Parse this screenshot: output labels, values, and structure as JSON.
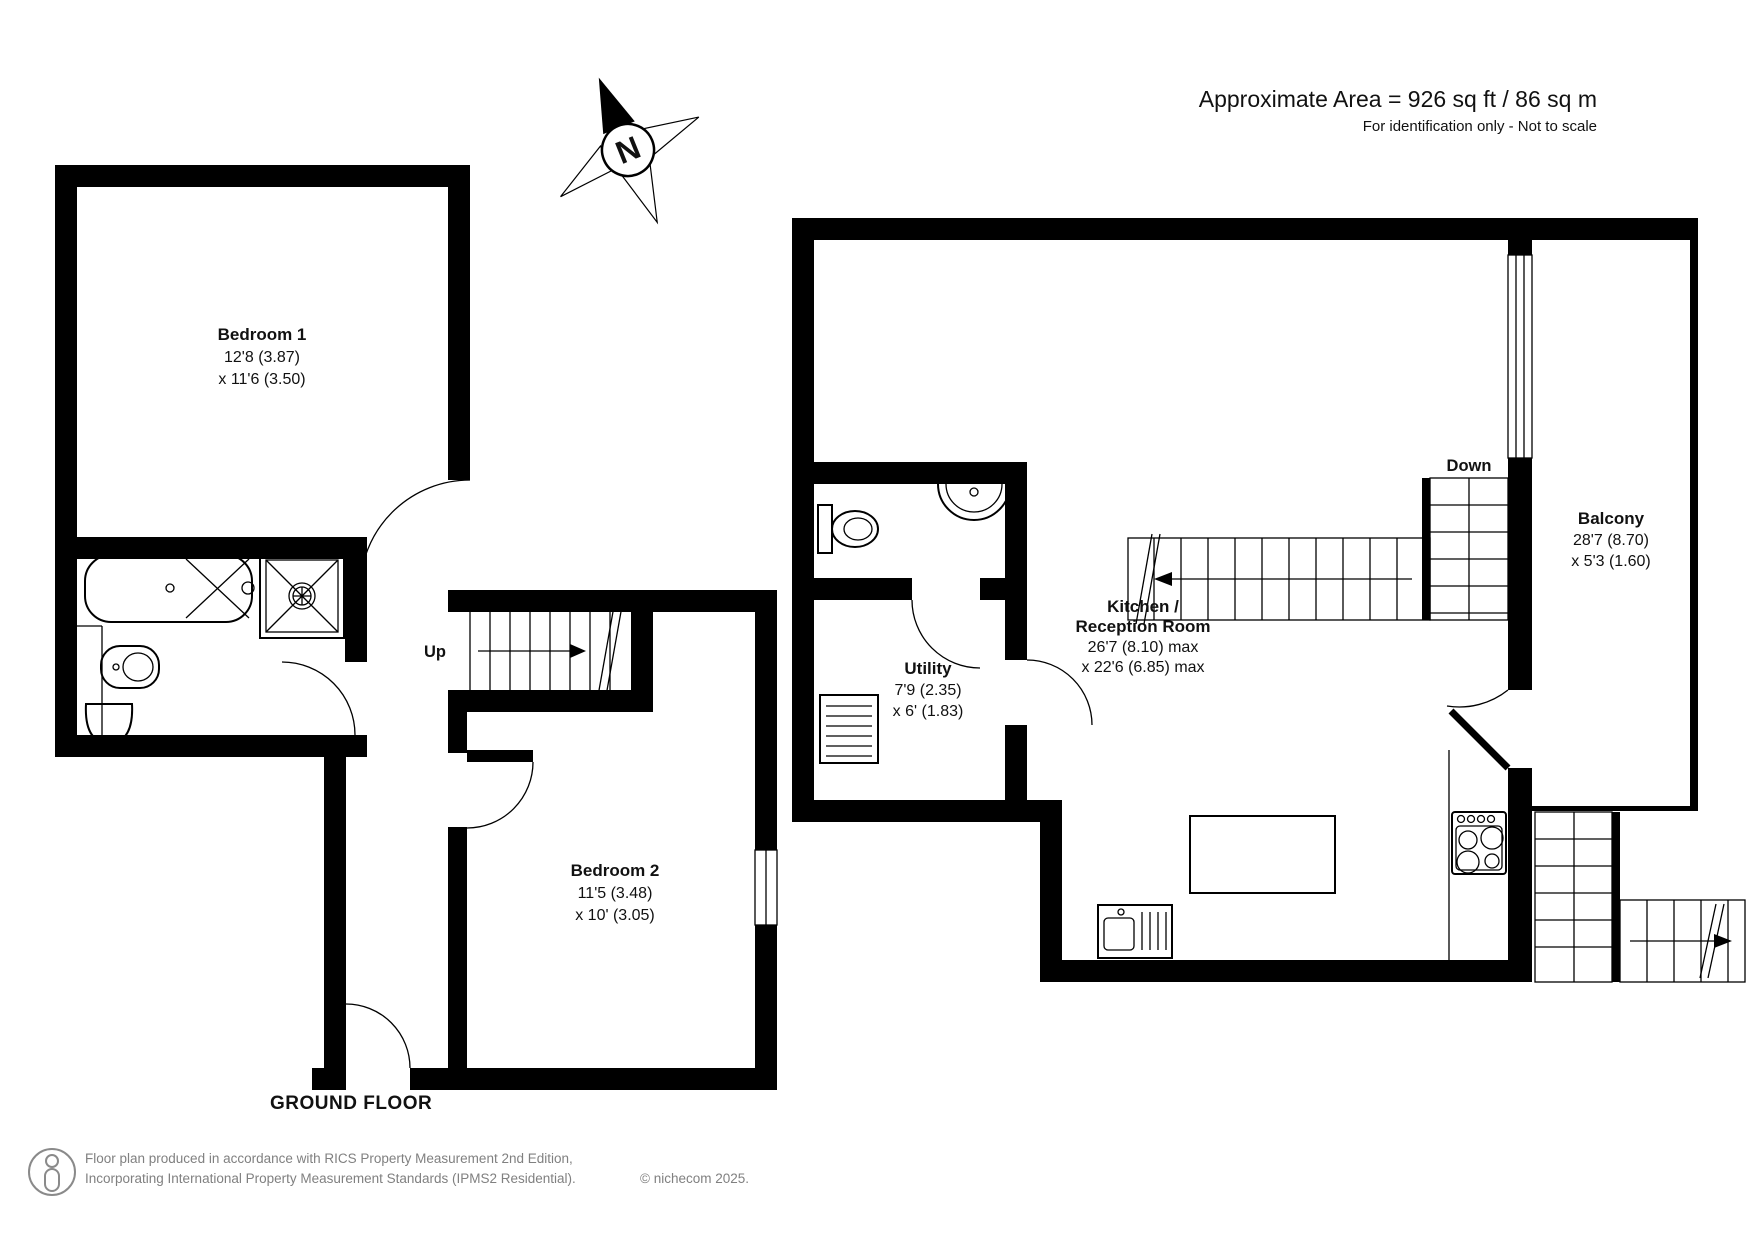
{
  "header": {
    "area": "Approximate Area = 926 sq ft / 86 sq m",
    "note": "For identification only - Not to scale"
  },
  "compass": {
    "north": "N"
  },
  "floor": {
    "label": "GROUND FLOOR"
  },
  "rooms": {
    "bedroom1": {
      "name": "Bedroom 1",
      "dim1": "12'8 (3.87)",
      "dim2": "x 11'6 (3.50)"
    },
    "bedroom2": {
      "name": "Bedroom 2",
      "dim1": "11'5 (3.48)",
      "dim2": "x 10' (3.05)"
    },
    "kitchen": {
      "name1": "Kitchen /",
      "name2": "Reception Room",
      "dim1": "26'7 (8.10) max",
      "dim2": "x 22'6 (6.85) max"
    },
    "utility": {
      "name": "Utility",
      "dim1": "7'9 (2.35)",
      "dim2": "x 6' (1.83)"
    },
    "balcony": {
      "name": "Balcony",
      "dim1": "28'7 (8.70)",
      "dim2": "x 5'3 (1.60)"
    }
  },
  "stairs": {
    "up": "Up",
    "down": "Down"
  },
  "footer": {
    "line1": "Floor plan produced in accordance with RICS Property Measurement 2nd Edition,",
    "line2": "Incorporating International Property Measurement Standards (IPMS2 Residential).",
    "copyright": "© nichecom 2025."
  },
  "colors": {
    "wall": "#000000",
    "muted": "#808080"
  }
}
